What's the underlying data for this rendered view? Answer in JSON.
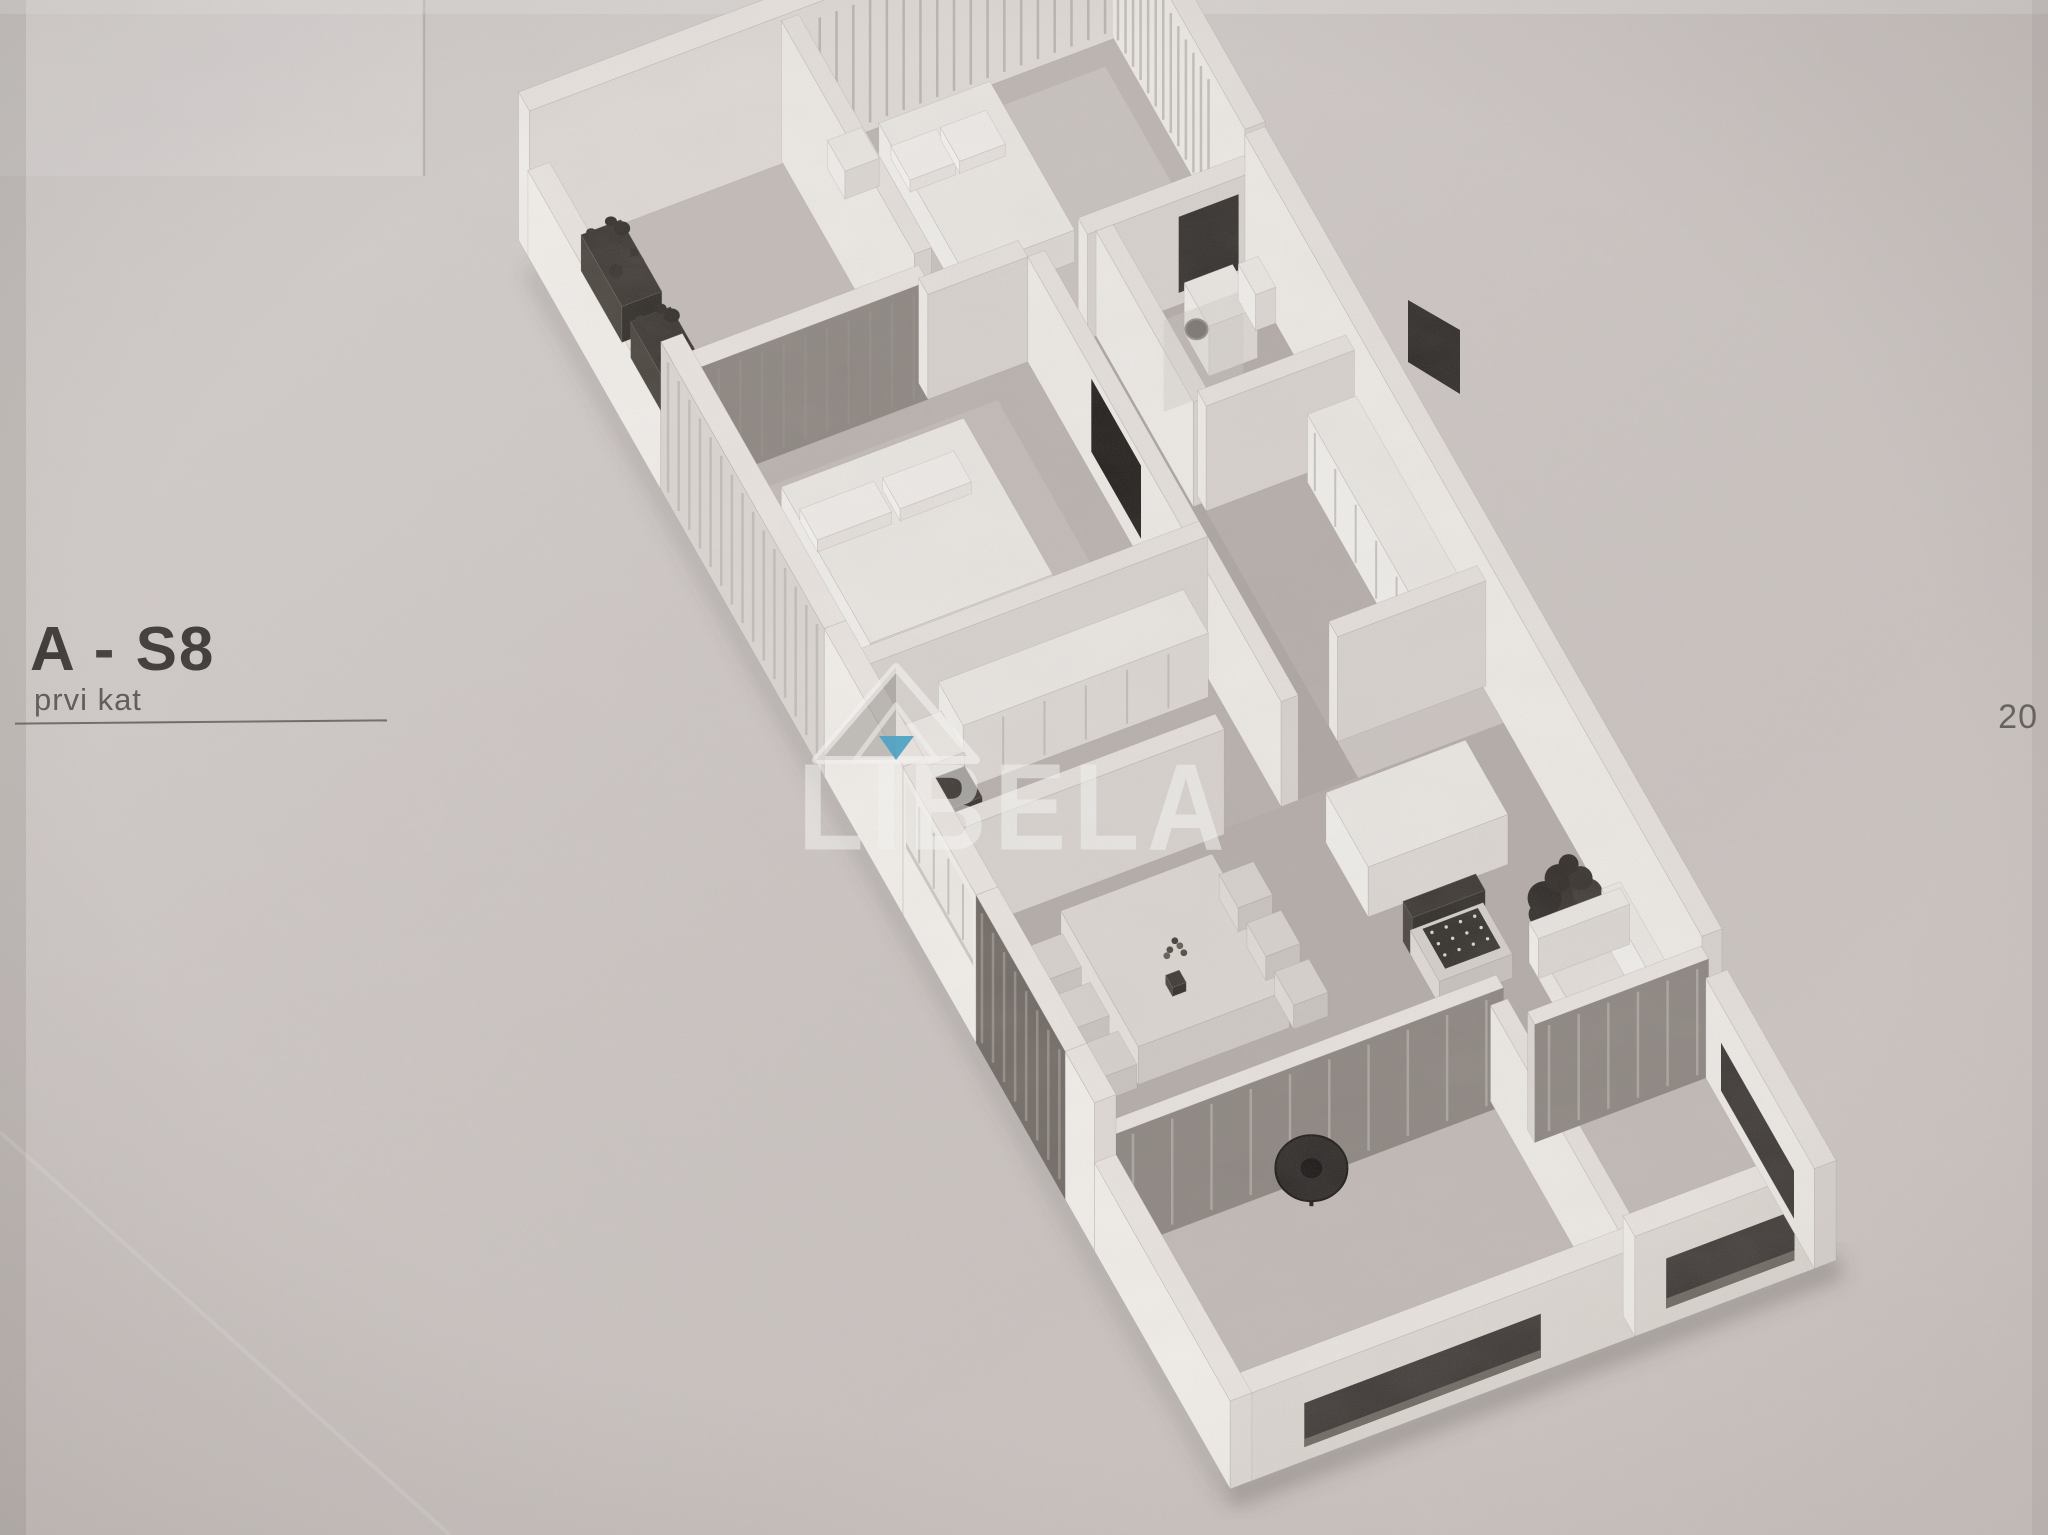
{
  "page": {
    "width": 2048,
    "height": 1535,
    "kind": "scanned real-estate brochure page",
    "background_color": "#ccc5c2"
  },
  "label": {
    "unit": "A - S8",
    "floor": "prvi kat"
  },
  "page_number": "20",
  "watermark": {
    "text": "LIBELA",
    "logo": "spirit-level-triangle-logo",
    "text_color": "#faf9f7",
    "bubble_color": "#3f9fc5"
  },
  "floorplan": {
    "style": "isometric 3D apartment cutaway render, monochrome",
    "rooms": [
      "loggia with planter boxes",
      "bedroom 1",
      "bedroom 2",
      "hallway",
      "bathroom",
      "walk-in closet",
      "office bedroom",
      "kitchen",
      "dining area",
      "living room",
      "terrace left",
      "terrace right"
    ],
    "furniture": [
      "planter boxes with plants",
      "single bed with pillows",
      "double bed with pillows",
      "wall-mounted tv",
      "wardrobe",
      "desk with dark chair",
      "washing machine",
      "toilet",
      "kitchen counter with cooktop and sink",
      "upper kitchen cabinets",
      "dining table with six chairs and vase",
      "island cabinet",
      "sofa",
      "armchair with patterned cushion",
      "potted plant",
      "round coffee table",
      "standing fan on terrace"
    ]
  },
  "colors": {
    "paper": "#ccc5c2",
    "walls": "#f1eeea",
    "floors": "#b3aba7",
    "dark_accents": "#2c2824",
    "accent_blue": "#3f9fc5",
    "text_dark": "#34312e",
    "text_muted": "#5f5b58"
  }
}
